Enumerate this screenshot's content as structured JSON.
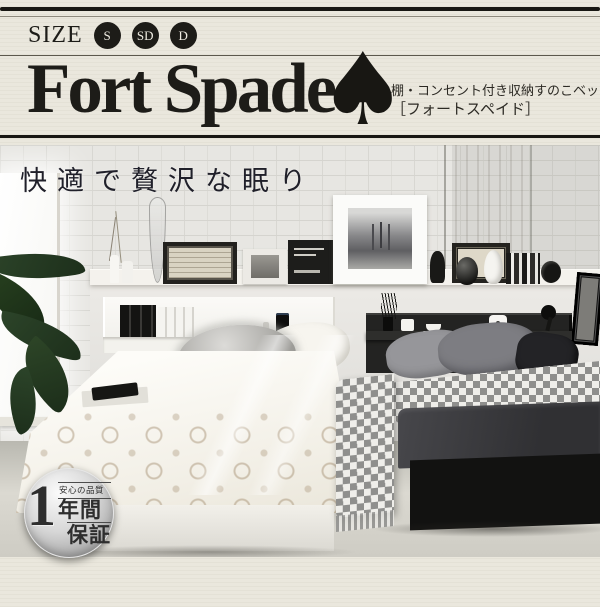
{
  "header": {
    "size_label": "SIZE",
    "size_options": [
      "S",
      "SD",
      "D"
    ],
    "brand": "Fort Spade",
    "subtitle_line1": "棚・コンセント付き収納すのこベッド",
    "subtitle_line2": "［フォートスペイド］"
  },
  "icons": {
    "spade": "♠"
  },
  "photo": {
    "headline": "快適で贅沢な眠り"
  },
  "badge": {
    "number": "1",
    "quality_label": "安心の品質",
    "period_label": "年間",
    "warranty_label": "保証"
  },
  "colors": {
    "background_cream": "#eae7dd",
    "ink_black": "#1d1c18",
    "badge_silver": "#c9c9c9",
    "plant_green": "#2c4429",
    "bed_white": "#f2efe6",
    "bed_black": "#121211"
  }
}
